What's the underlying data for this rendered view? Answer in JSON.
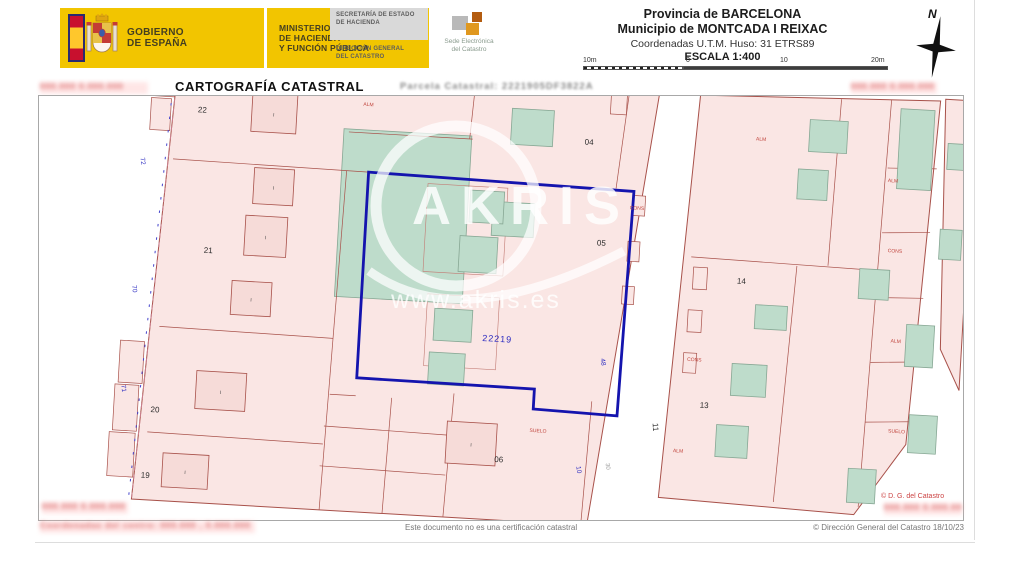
{
  "header": {
    "gobierno": {
      "line1": "GOBIERNO",
      "line2": "DE ESPAÑA"
    },
    "ministerio": {
      "line1": "MINISTERIO",
      "line2": "DE HACIENDA",
      "line3": "Y FUNCIÓN PÚBLICA"
    },
    "secretaria": {
      "line1": "SECRETARÍA DE ESTADO",
      "line2": "DE HACIENDA"
    },
    "direccion": {
      "line1": "DIRECCIÓN GENERAL",
      "line2": "DEL CATASTRO"
    },
    "sede": {
      "line1": "Sede Electrónica",
      "line2": "del Catastro"
    },
    "province": "Provincia de BARCELONA",
    "municipality": "Municipio de MONTCADA I REIXAC",
    "utm": "Coordenadas U.T.M. Huso: 31 ETRS89",
    "scale": "ESCALA 1:400",
    "scalebar": [
      "10m",
      "0",
      "10",
      "20m"
    ],
    "compass": "N"
  },
  "titlebar": {
    "title": "CARTOGRAFÍA CATASTRAL",
    "parcel_label": "Parcela Catastral:",
    "parcel_ref": "2221905DF3822A"
  },
  "map": {
    "parcels": [
      "22",
      "21",
      "20",
      "19",
      "04",
      "05",
      "06",
      "13",
      "14",
      "11"
    ],
    "roman": "I",
    "ref": "22219",
    "street_numbers": [
      "72",
      "70",
      "71",
      "48",
      "10"
    ],
    "gray_label": "30",
    "red_labels": [
      "ALM",
      "CONS",
      "ALM",
      "CONS",
      "ALM",
      "ALM",
      "CONS",
      "ALM",
      "SUELO",
      "SUELO"
    ],
    "watermark": {
      "brand": "AKRIS",
      "url": "www.akris.es"
    },
    "copyright": "© D. G. del Catastro"
  },
  "redacted": {
    "top_left": "000.000  0.000.000",
    "top_right": "000.000  0.000.000",
    "bottom_left": "000.000  0.000.000",
    "bottom_right": "000.000  0.000.000",
    "footer": "Coordenadas del centro:  000.000 , 0.000.000"
  },
  "footer": {
    "disclaimer": "Este documento no es una certificación catastral",
    "copyright": "© Dirección General del Catastro 18/10/23"
  }
}
